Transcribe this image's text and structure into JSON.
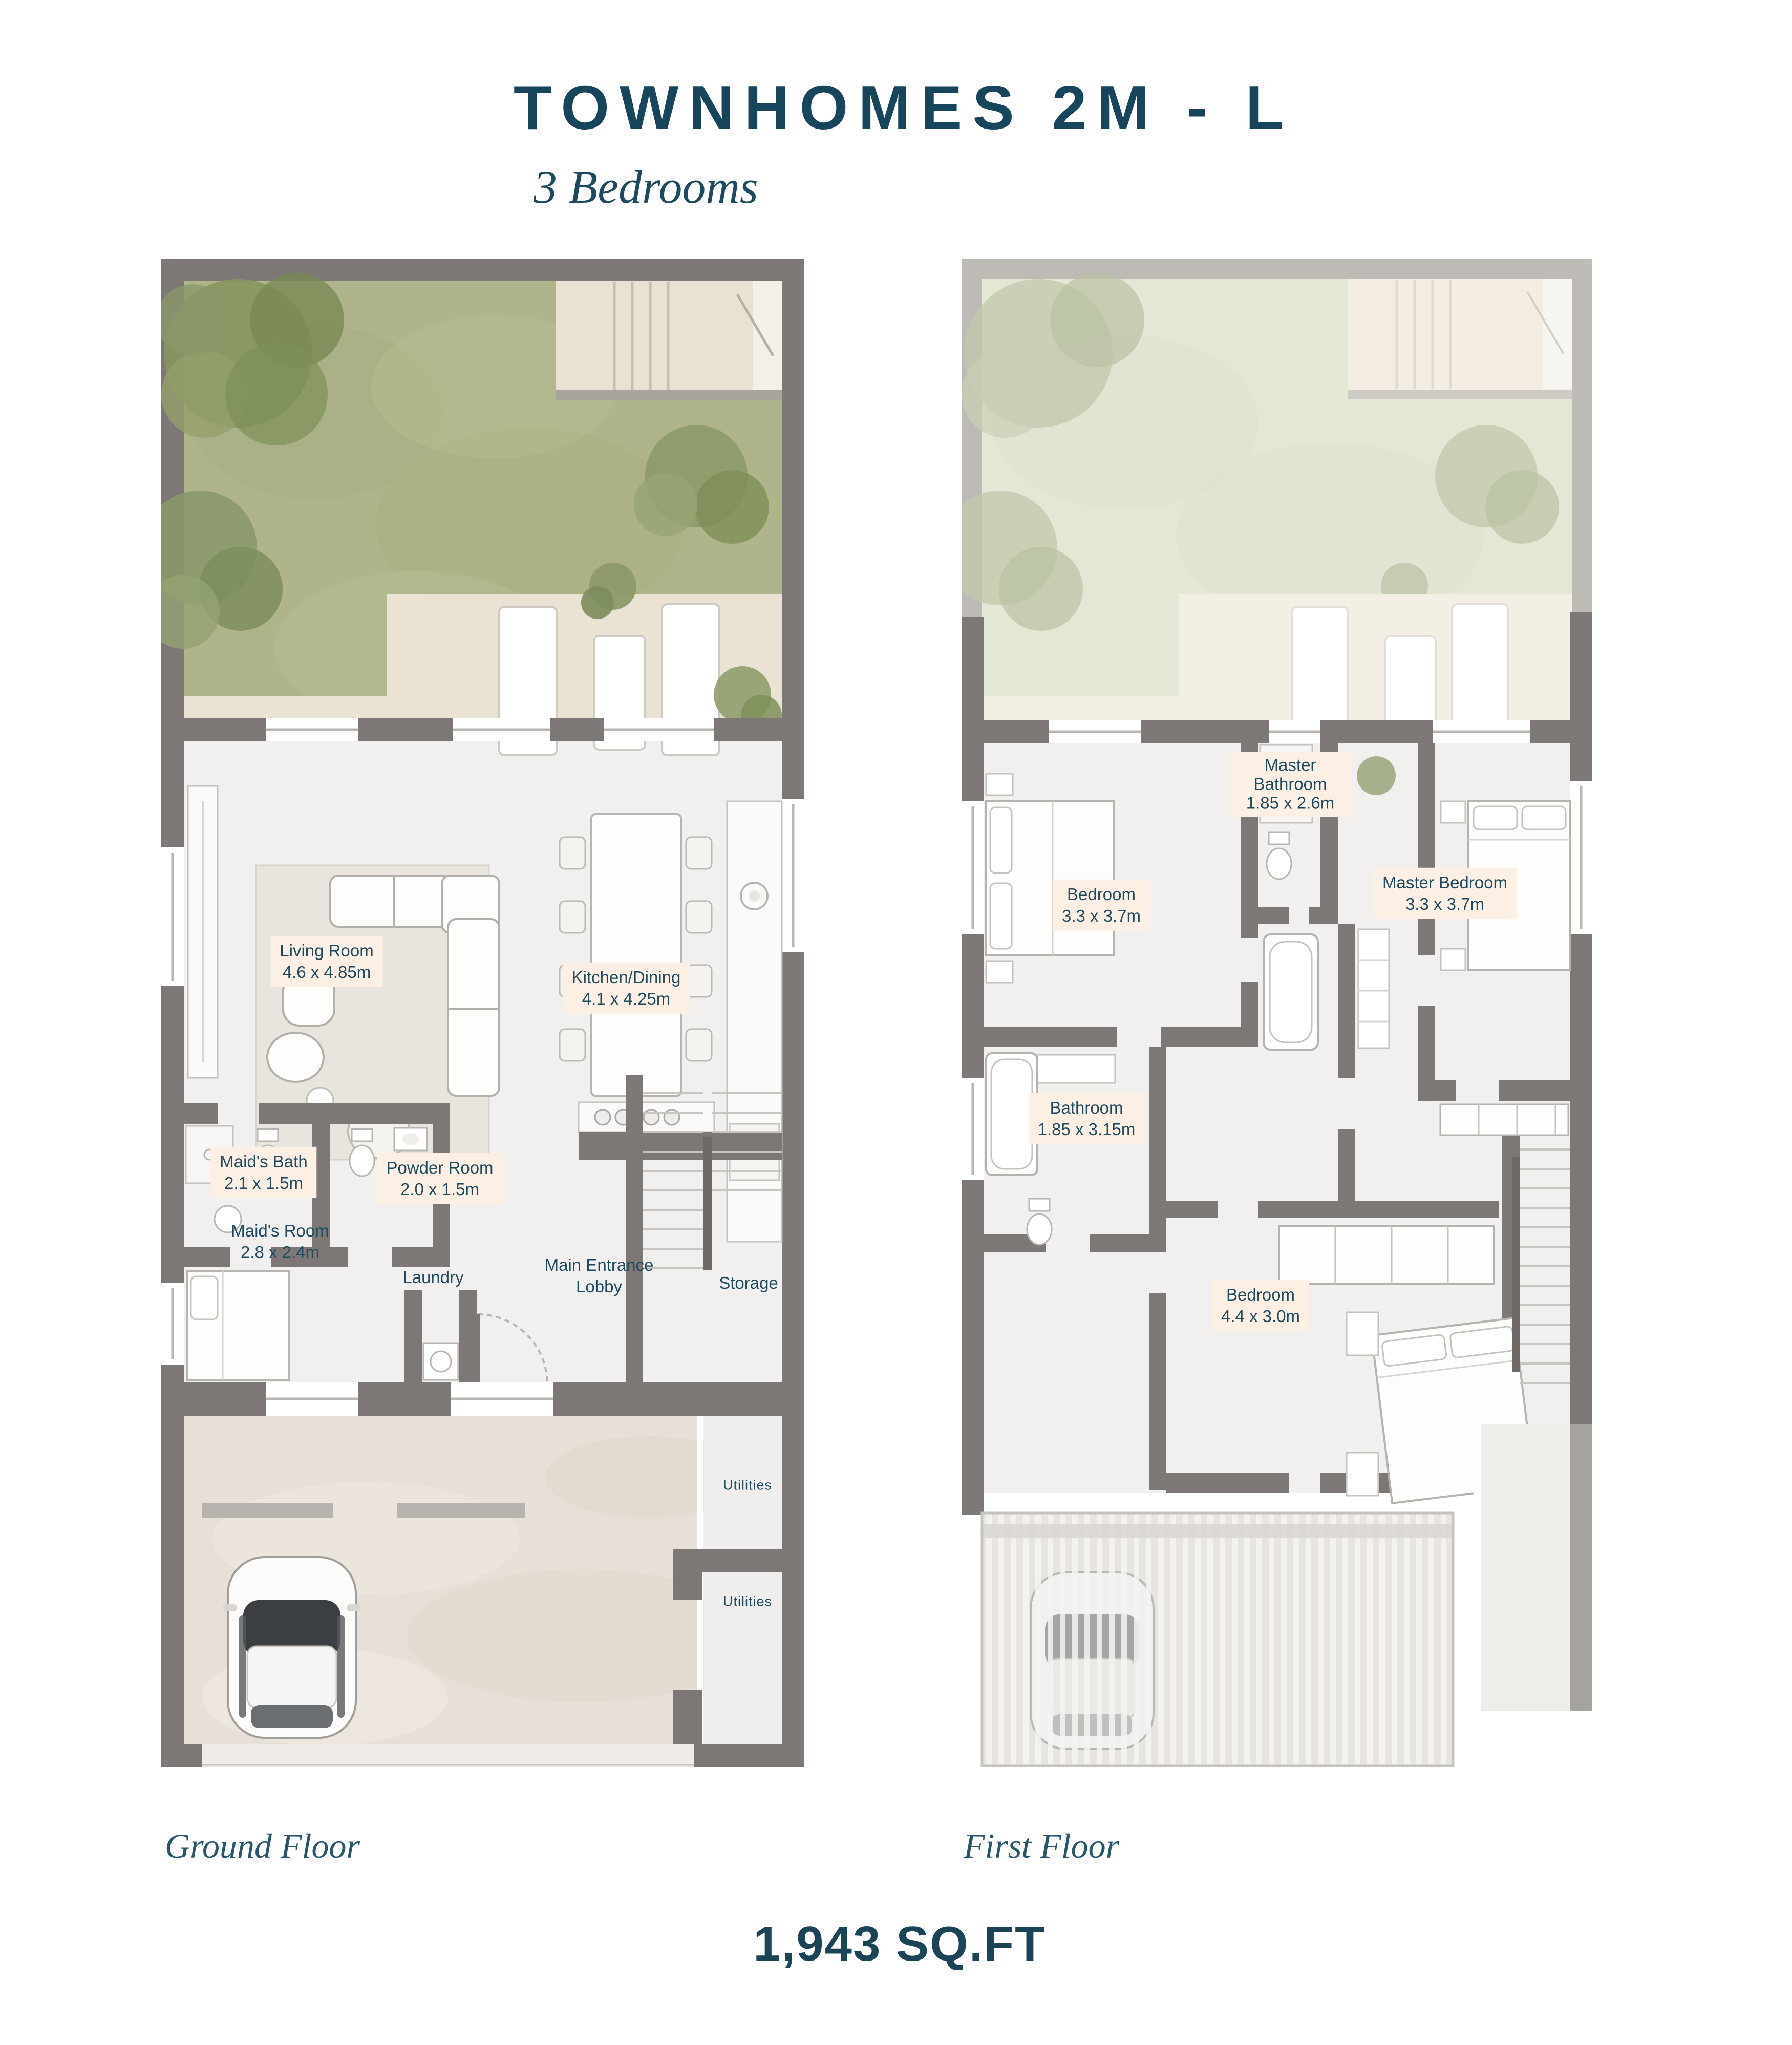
{
  "header": {
    "title": "TOWNHOMES 2M - L",
    "subtitle": "3 Bedrooms"
  },
  "floors": [
    {
      "caption": "Ground Floor",
      "rooms": [
        {
          "name": "Living Room",
          "dims": "4.6 x 4.85m"
        },
        {
          "name": "Kitchen/Dining",
          "dims": "4.1 x 4.25m"
        },
        {
          "name": "Maid's Bath",
          "dims": "2.1 x 1.5m"
        },
        {
          "name": "Powder Room",
          "dims": "2.0 x 1.5m"
        },
        {
          "name": "Maid's Room",
          "dims": "2.8 x 2.4m"
        },
        {
          "name": "Laundry"
        },
        {
          "name": "Main Entrance Lobby"
        },
        {
          "name": "Storage"
        },
        {
          "name": "Utilities"
        },
        {
          "name": "Utilities"
        }
      ]
    },
    {
      "caption": "First Floor",
      "rooms": [
        {
          "name": "Master Bathroom",
          "dims": "1.85 x 2.6m"
        },
        {
          "name": "Bedroom",
          "dims": "3.3 x 3.7m"
        },
        {
          "name": "Master Bedroom",
          "dims": "3.3 x 3.7m"
        },
        {
          "name": "Bathroom",
          "dims": "1.85 x 3.15m"
        },
        {
          "name": "Bedroom",
          "dims": "4.4 x 3.0m"
        }
      ]
    }
  ],
  "footer": {
    "area": "1,943 SQ.FT"
  },
  "icons": {
    "car": "car-top-view",
    "tree": "tree-canopy",
    "stairs": "staircase",
    "lounger": "sun-lounger",
    "pergola": "pergola-slats"
  },
  "colors": {
    "title_text": "#16455c",
    "label_text": "#1d4a5f",
    "label_bg": "#fcf0e5",
    "wall": "#7d7876",
    "wall_faded": "#aeaaa6",
    "lawn": "#afb48a",
    "lawn_faded": "#dfe2cb",
    "patio": "#eae3d3",
    "interior_floor": "#f1f0ee",
    "driveway": "#e7e0d8"
  }
}
